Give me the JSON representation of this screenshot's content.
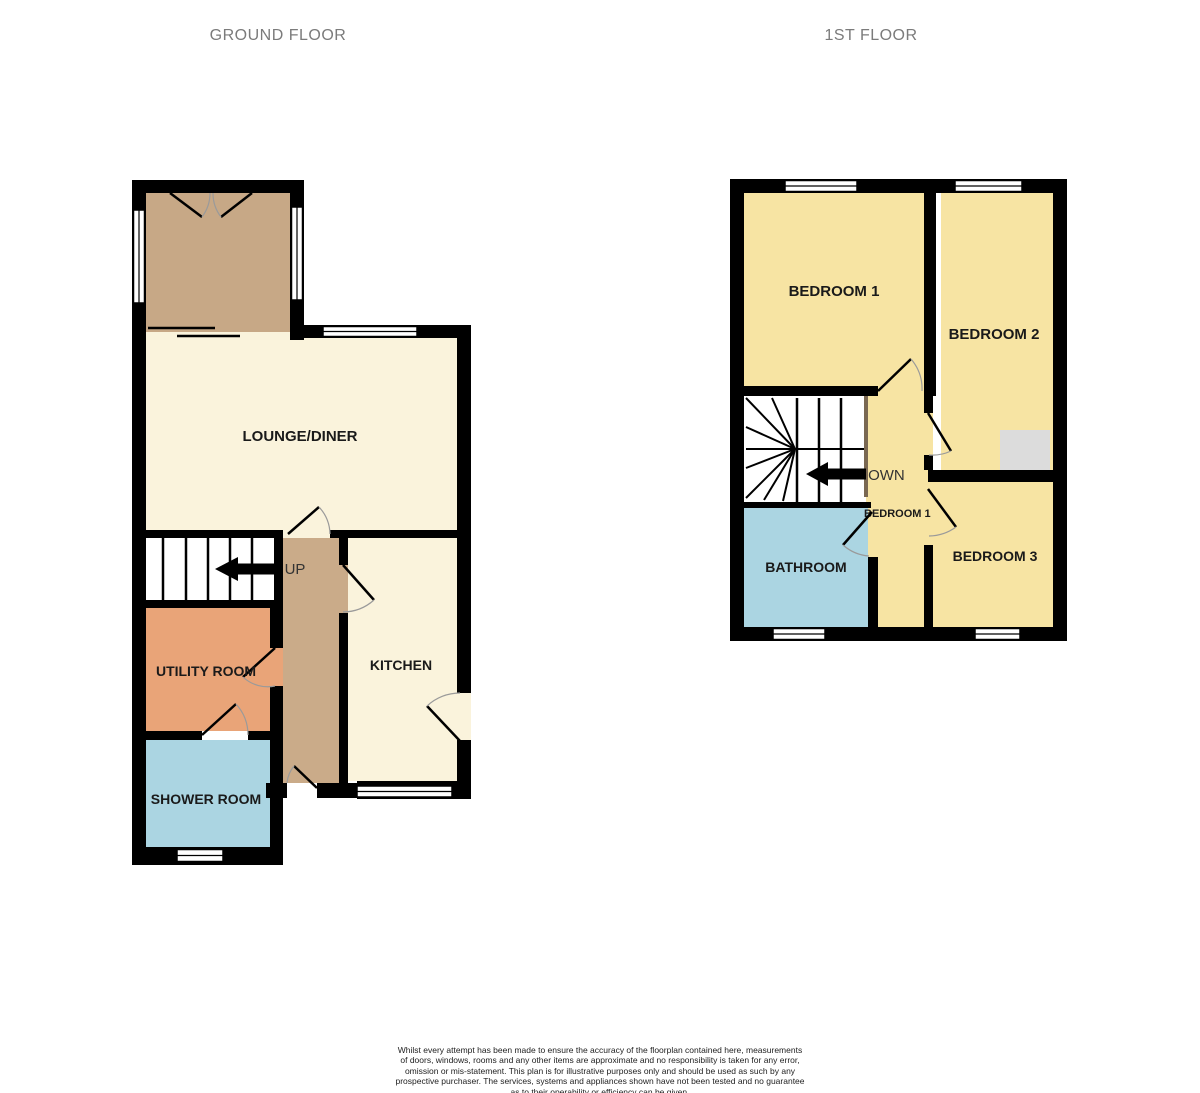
{
  "titles": {
    "ground_floor": "GROUND FLOOR",
    "first_floor": "1ST FLOOR"
  },
  "ground": {
    "lounge": "LOUNGE/DINER",
    "kitchen": "KITCHEN",
    "utility": "UTILITY ROOM",
    "shower": "SHOWER ROOM",
    "up": "UP"
  },
  "first": {
    "bedroom1": "BEDROOM 1",
    "bedroom2": "BEDROOM 2",
    "bedroom3": "BEDROOM 3",
    "bathroom": "BATHROOM",
    "down": "DOWN",
    "landing_label": "BEDROOM 1"
  },
  "footer": {
    "disclaimer": "Whilst every attempt has been made to ensure the accuracy of the floorplan contained here, measurements\nof doors, windows, rooms and any other items are approximate and no responsibility is taken for any error,\nomission or mis-statement. This plan is for illustrative purposes only and should be used as such by any\nprospective purchaser. The services, systems and appliances shown have not been tested and no guarantee\nas to their operability or efficiency can be given.",
    "credit": "Made with Metropix ©2025"
  },
  "colors": {
    "wall": "#000000",
    "cream": "#faf3dc",
    "tan": "#c7a886",
    "hall_tan": "#caab89",
    "yellow": "#f7e4a3",
    "orange": "#e9a478",
    "blue": "#abd5e2",
    "cupboard_gray": "#dcdcdc",
    "stairs_white": "#ffffff",
    "rail_brown": "#7a6852",
    "title_gray": "#7b7b7b"
  }
}
